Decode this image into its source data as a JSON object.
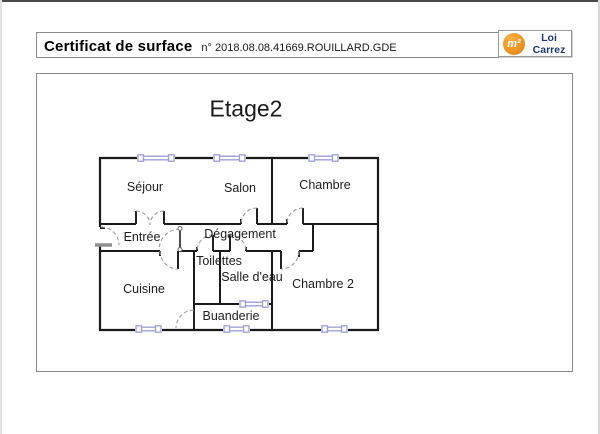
{
  "header": {
    "title": "Certificat de surface",
    "document_number": "n° 2018.08.08.41669.ROUILLARD.GDE"
  },
  "logo": {
    "symbol": "m²",
    "label_line1": "Loi",
    "label_line2": "Carrez"
  },
  "floorplan": {
    "title": "Etage2",
    "rooms": [
      {
        "name": "Séjour"
      },
      {
        "name": "Salon"
      },
      {
        "name": "Chambre"
      },
      {
        "name": "Entrée"
      },
      {
        "name": "Dégagement"
      },
      {
        "name": "Toilettes"
      },
      {
        "name": "Salle d'eau"
      },
      {
        "name": "Cuisine"
      },
      {
        "name": "Chambre 2"
      },
      {
        "name": "Buanderie"
      }
    ]
  },
  "colors": {
    "wall": "#1a1a1a",
    "window_accent": "#9c9cd6",
    "door_arc": "#9a9a9a",
    "logo_orange": "#ec9527",
    "logo_navy": "#1f3a6e",
    "box_border": "#8a8a8a"
  }
}
